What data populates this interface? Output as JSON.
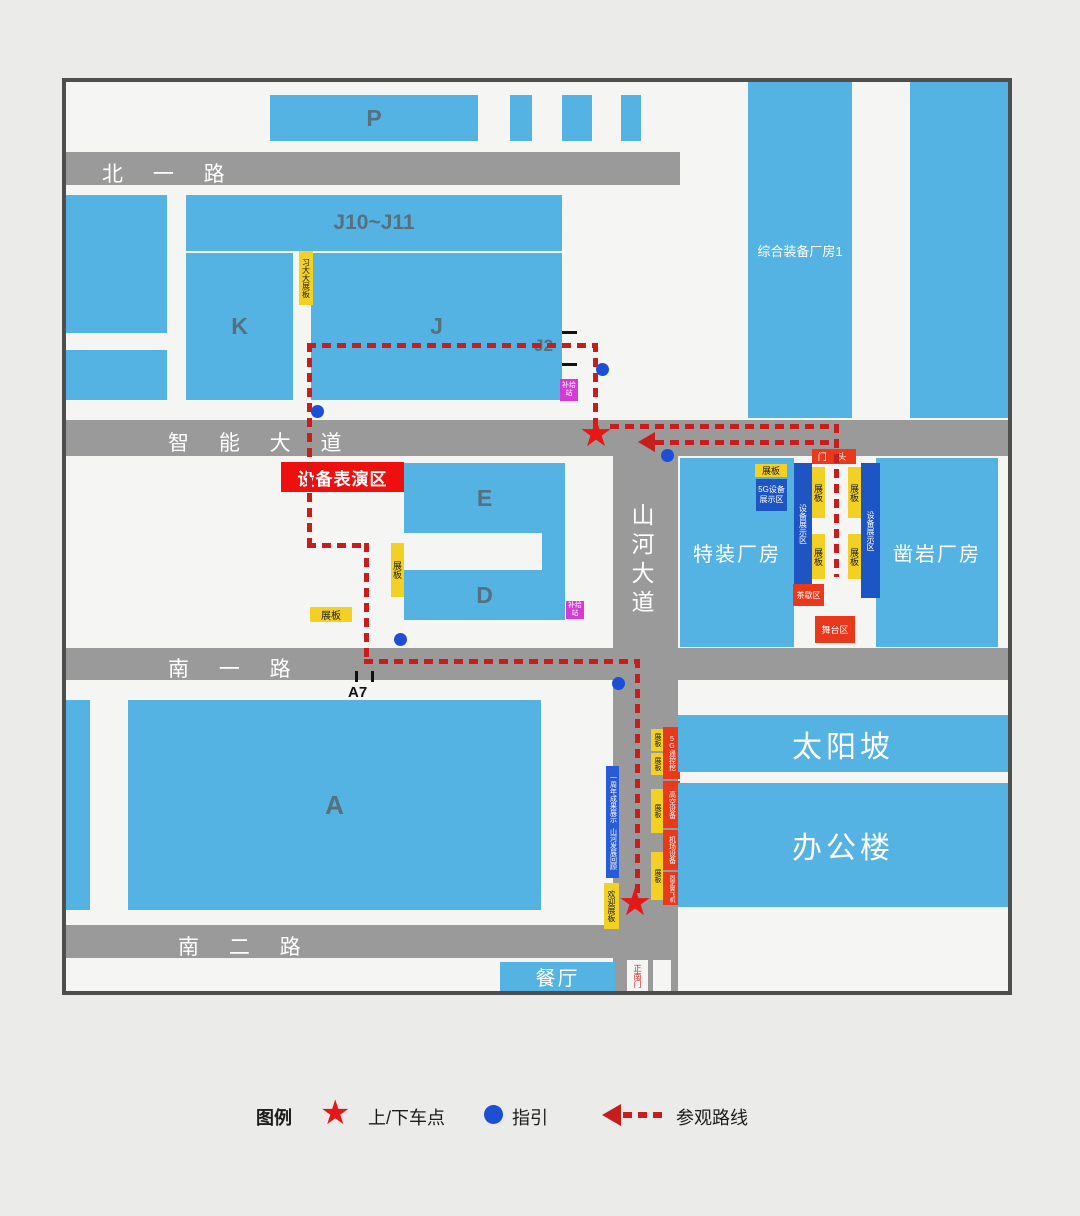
{
  "roads": {
    "north_1": "北 一 路",
    "smart_avenue": "智 能 大 道",
    "shanhe_avenue": "山河大道",
    "south_1": "南 一 路",
    "south_2": "南 二 路"
  },
  "buildings": {
    "parking": "P",
    "j10_j11": "J10~J11",
    "k": "K",
    "j": "J",
    "j2": "J2",
    "e": "E",
    "d": "D",
    "a": "A",
    "a7": "A7",
    "comprehensive_plant": "综合装备厂房1",
    "special_plant": "特装厂房",
    "rock_drill_plant": "凿岩厂房",
    "sun_slope": "太阳坡",
    "office": "办公楼",
    "canteen": "餐厅"
  },
  "zones": {
    "device_performance": "设备表演区",
    "gate_head": "门 头",
    "equipment_display": "设备展示区",
    "g5_display": "5G设备展示区",
    "tea_break": "茶歇区",
    "stage": "舞台区",
    "south_gate": "正南门"
  },
  "boards": {
    "zhanban": "展板",
    "xi_board": "习大大展板",
    "supply_station": "补给站",
    "welcome_board": "欢迎展板",
    "anniversary_line1": "一周年成果展示",
    "anniversary_line2": "山河发展回顾",
    "g5_excavator": "5G遥控挖",
    "aerial_equipment": "高空设备",
    "airport_equipment": "机场设备",
    "fixed_wing": "固定翼飞机"
  },
  "legend": {
    "title": "图例",
    "pickup": "上/下车点",
    "guide": "指引",
    "route": "参观路线"
  },
  "colors": {
    "road_gray": "#9a9a9a",
    "building_blue": "#55b3e3",
    "route_red": "#c81d1d",
    "star_red": "#e51717",
    "dot_blue": "#1d4fd6",
    "board_yellow": "#f2d124",
    "display_blue": "#1d55c4",
    "supply_magenta": "#d43bd4",
    "zone_red": "#e8391c",
    "banner_red": "#ee0f0f"
  }
}
